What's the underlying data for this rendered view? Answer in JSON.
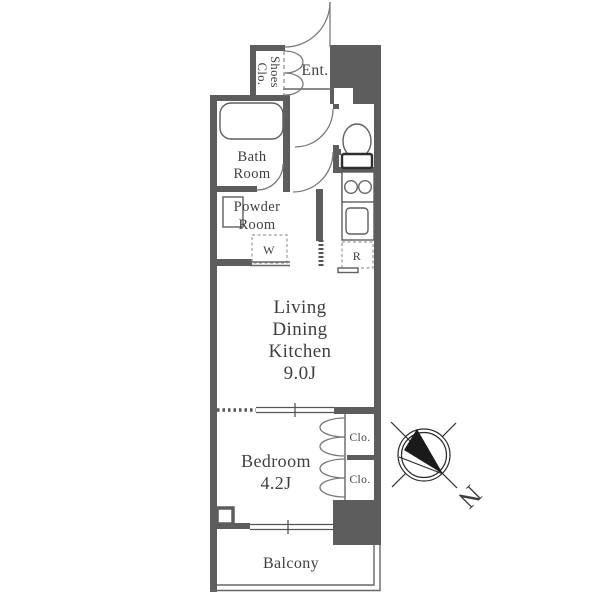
{
  "rooms": {
    "entrance": {
      "label": "Ent."
    },
    "shoes_closet": {
      "line1": "Shoes",
      "line2": "Clo."
    },
    "bathroom": {
      "line1": "Bath",
      "line2": "Room"
    },
    "powder_room": {
      "line1": "Powder",
      "line2": "Room"
    },
    "washer": {
      "label": "W"
    },
    "refrigerator": {
      "label": "R"
    },
    "ldk": {
      "line1": "Living",
      "line2": "Dining",
      "line3": "Kitchen",
      "line4": "9.0J"
    },
    "bedroom": {
      "line1": "Bedroom",
      "line2": "4.2J"
    },
    "closet_upper": {
      "label": "Clo."
    },
    "closet_lower": {
      "label": "Clo."
    },
    "balcony": {
      "label": "Balcony"
    }
  },
  "compass": {
    "north_label": "N"
  },
  "colors": {
    "wall": "#5d5d5d",
    "thin_line": "#666666",
    "door_line": "#7a7a7a",
    "text": "#3f3f3f",
    "compass": "#2b2b2b",
    "background": "#ffffff"
  }
}
